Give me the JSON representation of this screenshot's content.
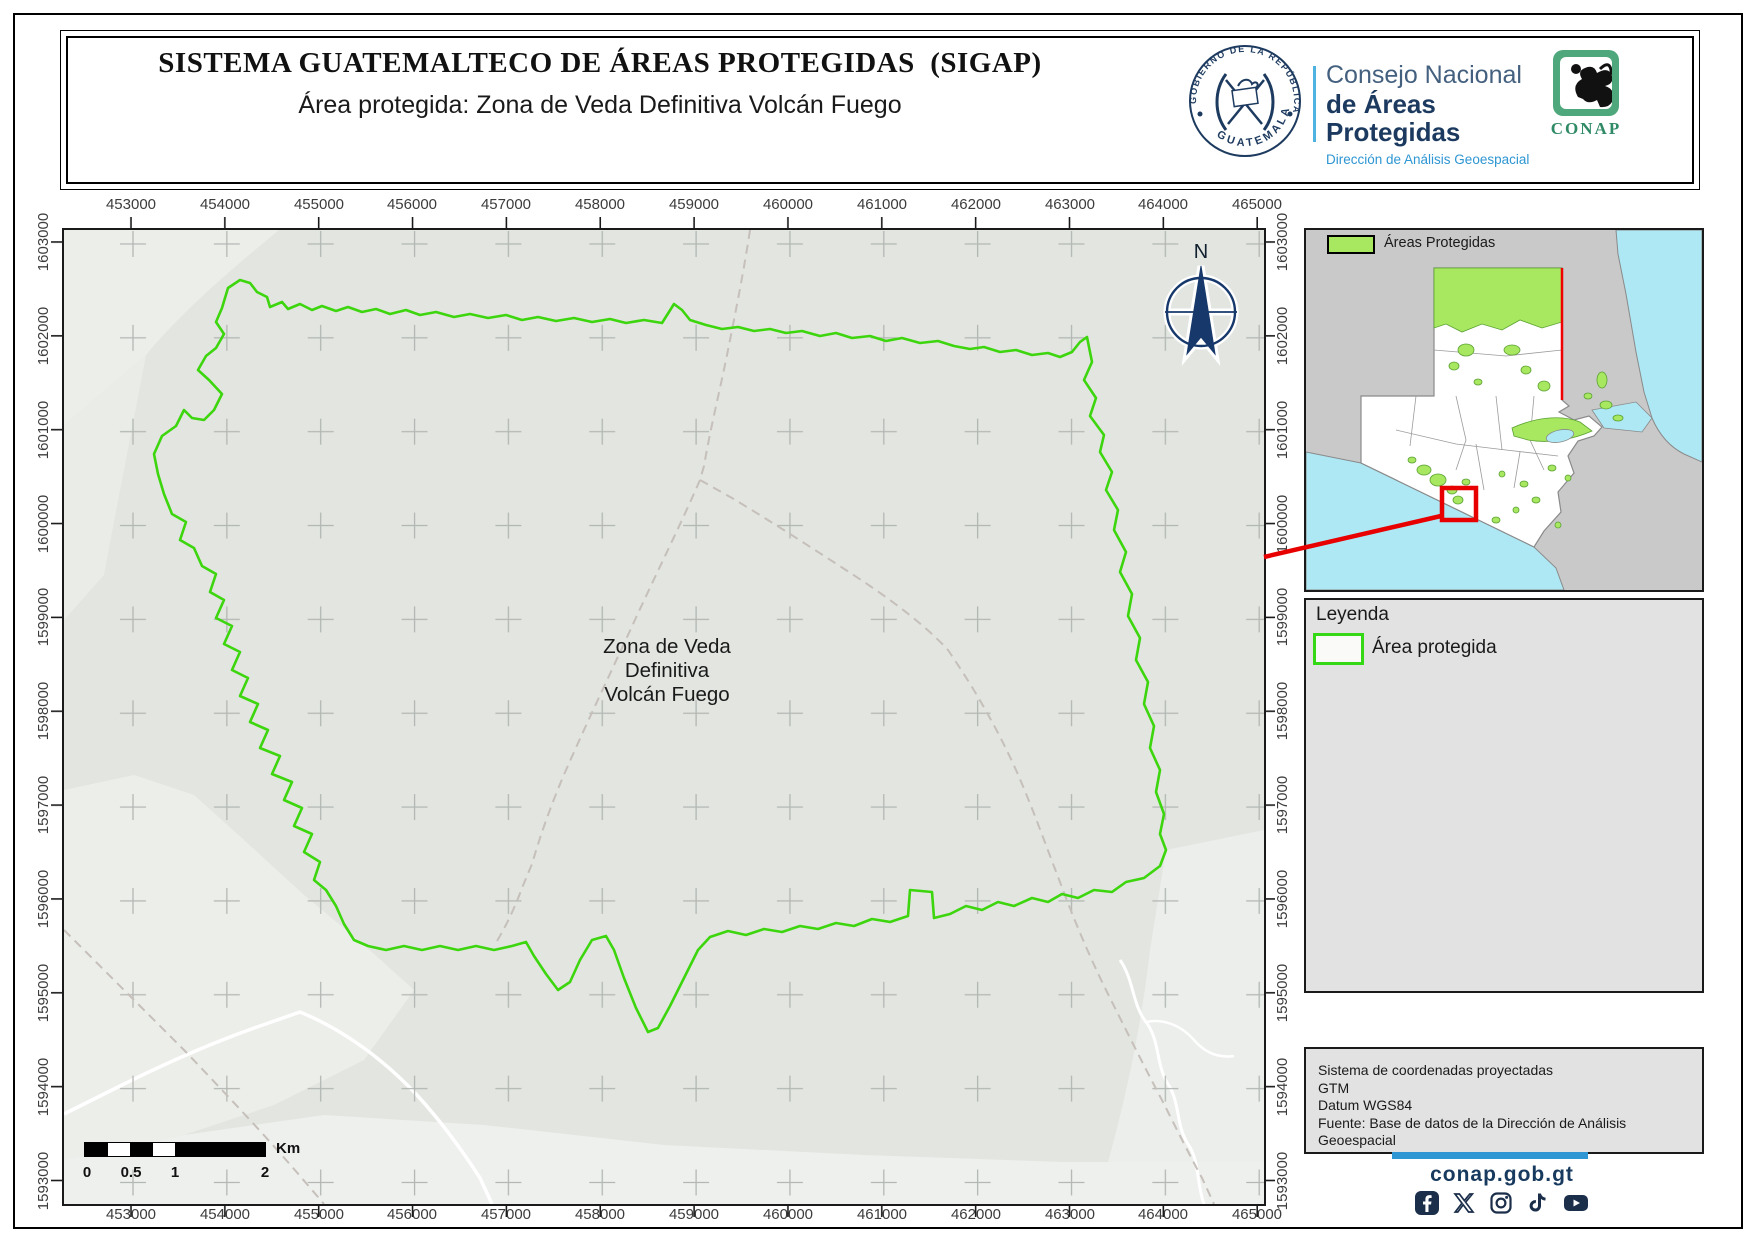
{
  "header": {
    "title": "SISTEMA GUATEMALTECO DE ÁREAS PROTEGIDAS  (SIGAP)",
    "subtitle": "Área protegida: Zona de Veda Definitiva Volcán Fuego",
    "seal": {
      "top_text": "GOBIERNO DE LA REPÚBLICA",
      "bottom_text": "GUATEMALA"
    },
    "org": {
      "line1": "Consejo Nacional",
      "line2": "de Áreas Protegidas",
      "line3": "Dirección de Análisis Geoespacial"
    },
    "conap": "CONAP"
  },
  "colors": {
    "map_bg": "#e2e5e0",
    "protected_green": "#3dd60e",
    "inset_green_fill": "#a8e860",
    "ocean": "#aee8f5",
    "red": "#e80000",
    "navy": "#173a5e",
    "light_blue": "#2e96d2",
    "panel_gray": "#e2e2e2"
  },
  "main_map": {
    "label1": "Zona de Veda",
    "label2": "Definitiva",
    "label3": "Volcán Fuego",
    "polygon_path": "M164,58 L176,50 L186,53 L193,62 L203,67 L206,77 L218,72 L224,79 L236,74 L248,80 L258,76 L272,81 L284,77 L298,82 L312,79 L326,84 L342,80 L356,85 L372,82 L390,87 L406,84 L424,88 L442,85 L458,90 L474,87 L492,91 L510,88 L528,92 L546,89 L562,93 L580,90 L598,93 L610,74 L618,80 L626,90 L642,95 L658,99 L674,97 L690,101 L706,99 L722,103 L738,101 L756,106 L772,103 L788,108 L806,106 L822,111 L838,108 L856,113 L874,111 L890,116 L906,119 L920,117 L936,122 L952,120 L968,125 L984,123 L996,127 L1008,122 L1016,112 L1023,107 L1028,132 L1020,150 L1032,168 L1026,186 L1040,205 L1036,222 L1048,242 L1042,260 L1054,280 L1050,300 L1062,322 L1056,342 L1068,364 L1064,386 L1076,408 L1072,430 L1084,452 L1080,474 L1090,496 L1086,518 L1096,540 L1092,562 L1100,584 L1096,604 L1102,620 L1096,636 L1080,648 L1062,652 L1048,662 L1030,660 L1014,668 L998,664 L984,672 L968,668 L950,676 L934,672 L918,680 L902,676 L886,684 L870,688 L868,662 L846,660 L844,686 L826,692 L808,689 L790,696 L772,693 L754,699 L736,696 L718,702 L700,699 L682,705 L664,701 L646,707 L634,720 L620,748 L606,776 L594,798 L584,802 L572,778 L560,748 L550,720 L542,706 L528,710 L516,730 L506,752 L494,760 L482,744 L470,726 L462,712 L448,716 L430,720 L412,716 L394,720 L376,716 L358,720 L340,716 L322,720 L304,716 L290,710 L280,694 L272,676 L262,660 L250,650 L256,632 L240,622 L248,604 L230,596 L238,578 L220,570 L228,552 L208,544 L216,526 L196,518 L204,500 L186,492 L194,474 L176,466 L184,448 L168,440 L176,422 L160,414 L168,396 L152,388 L160,370 L146,362 L152,344 L138,336 L130,318 L116,310 L122,292 L108,284 L100,264 L94,244 L90,224 L98,206 L112,196 L120,180 L128,188 L140,190 L150,180 L158,164 L145,150 L134,140 L142,126 L152,118 L160,104 L152,92 L158,78 Z",
    "road_a": "M686,0 C680,40 672,80 664,120 C656,160 646,200 640,236 L636,250",
    "road_b": "M636,250 C616,296 592,344 570,392 C548,440 524,490 502,540 C488,572 476,606 468,634 L458,658 C450,680 440,700 430,716",
    "road_c": "M636,250 L668,268 C708,292 748,318 788,344 C828,370 862,396 884,420 L892,432 C912,462 934,500 952,540 C968,576 982,616 996,652 C1010,690 1026,728 1044,764 C1062,800 1082,840 1100,874 C1112,898 1126,926 1138,948 L1150,974",
    "road_d": "M0,700 C40,740 80,780 120,820 C160,862 200,904 236,946 L260,974",
    "white_a": "M0,884 L56,856 C100,834 150,812 196,796 L236,782 C280,800 320,830 352,864 C376,890 398,920 416,948 L428,974",
    "white_b": "M1056,730 C1070,750 1068,774 1082,792 C1096,810 1092,836 1104,854 C1116,872 1112,896 1124,914 C1136,932 1132,952 1140,974",
    "white_c": "M1082,792 C1100,788 1118,796 1130,810 C1142,824 1156,828 1170,826"
  },
  "axes": {
    "x": [
      "453000",
      "454000",
      "455000",
      "456000",
      "457000",
      "458000",
      "459000",
      "460000",
      "461000",
      "462000",
      "463000",
      "464000",
      "465000"
    ],
    "y": [
      "1603000",
      "1602000",
      "1601000",
      "1600000",
      "1599000",
      "1598000",
      "1597000",
      "1596000",
      "1595000",
      "1594000",
      "1593000"
    ]
  },
  "north": {
    "label": "N"
  },
  "scalebar": {
    "l0": "0",
    "l1": "0.5",
    "l2": "1",
    "l3": "2",
    "unit": "Km"
  },
  "inset": {
    "legend_label": "Áreas Protegidas",
    "ocean_pacific": "M0,222 L55,233 L228,317 L250,338 L258,360 L0,360 Z",
    "ocean_caribbean": "M310,0 L396,0 L396,232 L378,224 C362,216 352,202 346,188 L338,162 L330,122 L320,64 L312,24 Z",
    "bay": "M286,180 L330,172 L346,188 L336,202 L298,198 Z",
    "guatemala": "M128,38 L256,38 L256,170 L263,176 L253,182 L268,190 L283,186 L296,197 L288,206 L272,211 L262,226 L268,243 L252,262 L255,282 L238,301 L228,317 L55,233 L55,166 L128,166 Z",
    "green_north": "M128,38 L256,38 L256,92 L236,98 L214,90 L196,100 L176,94 L156,102 L140,94 L128,98 Z",
    "green_east_ridge": "M206,198 C228,188 254,184 274,192 L286,201 C268,209 244,214 222,210 L208,206 Z",
    "belize_line": "M256,38 L256,170"
  },
  "legend": {
    "title": "Leyenda",
    "item": "Área protegida"
  },
  "credits": {
    "line1": "Sistema de coordenadas proyectadas",
    "line2": "GTM",
    "line3": "Datum WGS84",
    "line4": "Fuente: Base de datos de la Dirección de Análisis Geoespacial"
  },
  "footer": {
    "website": "conap.gob.gt"
  }
}
